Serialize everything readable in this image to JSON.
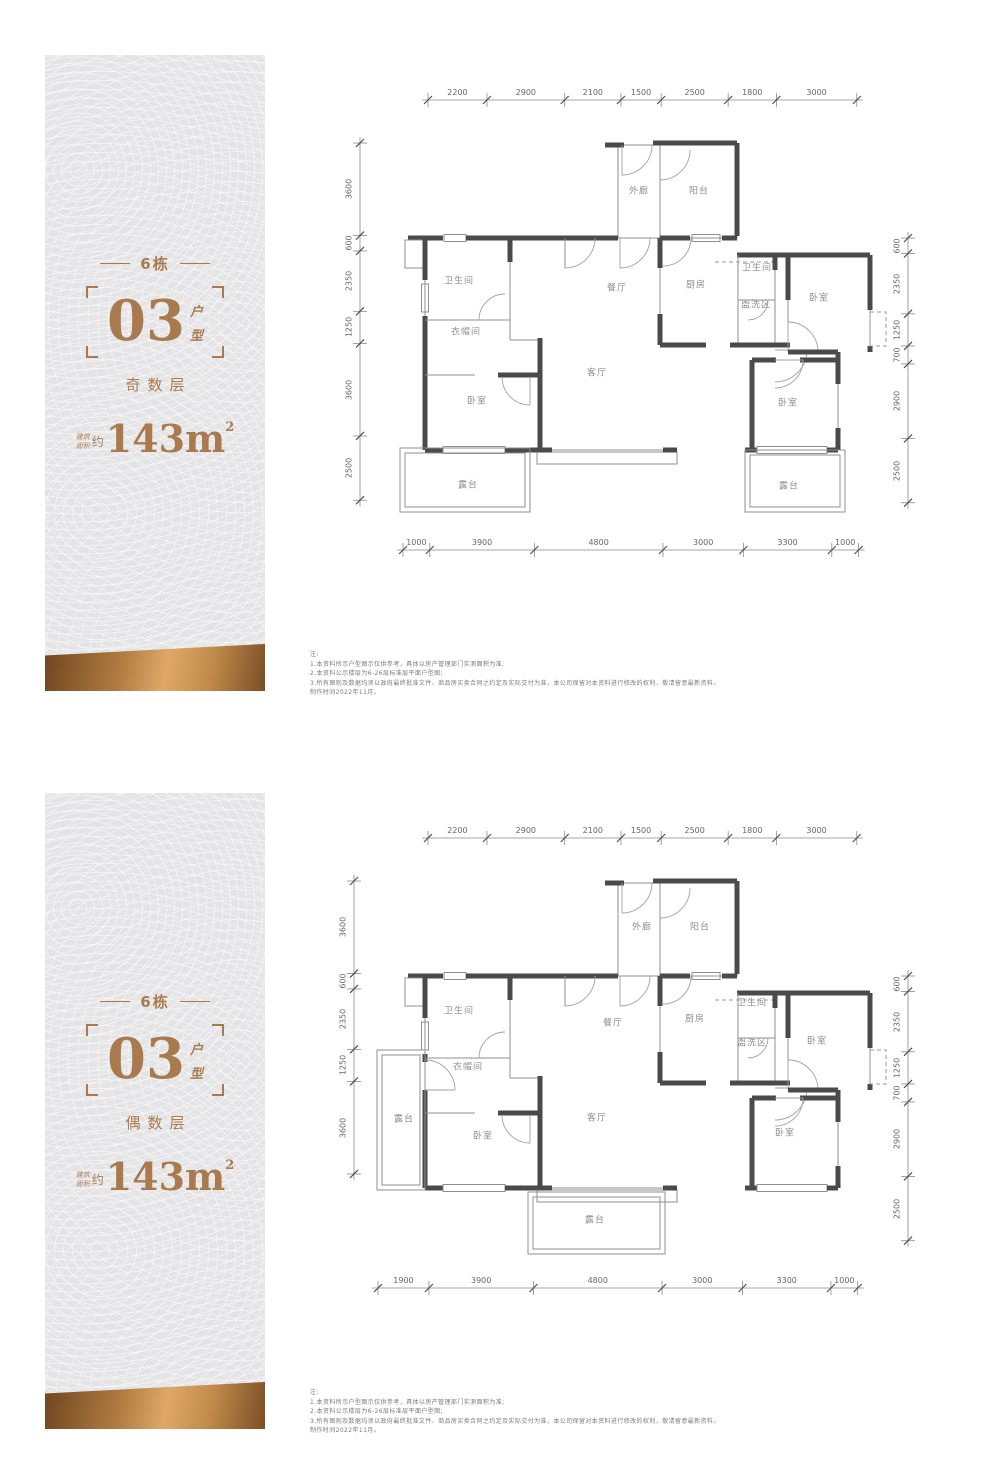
{
  "colors": {
    "bronze": "#a87a4e",
    "panel_bg": "#e4e4e6",
    "gold_dark": "#6f4520",
    "gold_light": "#dfa868",
    "wall_thick": "#4a4a4d",
    "wall_thin": "#8f8f92",
    "dim_text": "#66666a",
    "room_text": "#8f8f92",
    "note_text": "#7b7b7e"
  },
  "sections": [
    {
      "panel": {
        "building": "6栋",
        "unit": "03",
        "unit_side": [
          "户",
          "型"
        ],
        "floor_type": "奇数层",
        "area_small": [
          "建筑",
          "面积"
        ],
        "area_approx": "约",
        "area_value": "143m",
        "area_sup": "2"
      },
      "plan": {
        "dims_top": [
          "2200",
          "2900",
          "2100",
          "1500",
          "2500",
          "1800",
          "3000"
        ],
        "dims_bottom": [
          "1000",
          "3900",
          "4800",
          "3000",
          "3300",
          "1000"
        ],
        "dims_left": [
          "3600",
          "600",
          "2350",
          "1250",
          "3600",
          "2500"
        ],
        "dims_right": [
          "600",
          "2350",
          "1250",
          "700",
          "2900",
          "2500"
        ],
        "rooms": [
          {
            "label": "外廊",
            "x": 639,
            "y": 190
          },
          {
            "label": "阳台",
            "x": 699,
            "y": 190
          },
          {
            "label": "卫生间",
            "x": 459,
            "y": 280
          },
          {
            "label": "衣帽间",
            "x": 466,
            "y": 331
          },
          {
            "label": "餐厅",
            "x": 617,
            "y": 287
          },
          {
            "label": "厨房",
            "x": 696,
            "y": 284
          },
          {
            "label": "卫生间",
            "x": 757,
            "y": 267
          },
          {
            "label": "盥洗区",
            "x": 756,
            "y": 304
          },
          {
            "label": "卧室",
            "x": 819,
            "y": 297
          },
          {
            "label": "客厅",
            "x": 597,
            "y": 372
          },
          {
            "label": "卧室",
            "x": 477,
            "y": 400
          },
          {
            "label": "卧室",
            "x": 788,
            "y": 402
          },
          {
            "label": "露台",
            "x": 468,
            "y": 484
          },
          {
            "label": "露台",
            "x": 789,
            "y": 485
          }
        ]
      },
      "notes": [
        "注:",
        "1.本资料所示户型图示仅供参考，具体以房产管理部门实测面积为准;",
        "2.本资料公示楼层为6-26层标准层平面户型图;",
        "3.所有图则及数据均须以政府最终批准文件、商品房买卖合同之约定及实际交付为准，本公司保留对本资料进行修改的权利，敬请留意最新资料。",
        "制作时间2022年11月。"
      ]
    },
    {
      "panel": {
        "building": "6栋",
        "unit": "03",
        "unit_side": [
          "户",
          "型"
        ],
        "floor_type": "偶数层",
        "area_small": [
          "建筑",
          "面积"
        ],
        "area_approx": "约",
        "area_value": "143m",
        "area_sup": "2"
      },
      "plan": {
        "dims_top": [
          "2200",
          "2900",
          "2100",
          "1500",
          "2500",
          "1800",
          "3000"
        ],
        "dims_bottom": [
          "1900",
          "3900",
          "4800",
          "3000",
          "3300",
          "1000"
        ],
        "dims_left": [
          "3600",
          "600",
          "2350",
          "1250",
          "3600"
        ],
        "dims_right": [
          "600",
          "2350",
          "1250",
          "700",
          "2900",
          "2500"
        ],
        "rooms": [
          {
            "label": "外廊",
            "x": 642,
            "y": 926
          },
          {
            "label": "阳台",
            "x": 700,
            "y": 926
          },
          {
            "label": "卫生间",
            "x": 459,
            "y": 1010
          },
          {
            "label": "衣帽间",
            "x": 468,
            "y": 1066
          },
          {
            "label": "餐厅",
            "x": 613,
            "y": 1022
          },
          {
            "label": "厨房",
            "x": 695,
            "y": 1018
          },
          {
            "label": "卫生间",
            "x": 752,
            "y": 1002
          },
          {
            "label": "盥洗区",
            "x": 752,
            "y": 1042
          },
          {
            "label": "卧室",
            "x": 817,
            "y": 1040
          },
          {
            "label": "露台",
            "x": 404,
            "y": 1118
          },
          {
            "label": "卧室",
            "x": 483,
            "y": 1135
          },
          {
            "label": "客厅",
            "x": 597,
            "y": 1117
          },
          {
            "label": "卧室",
            "x": 785,
            "y": 1132
          },
          {
            "label": "露台",
            "x": 595,
            "y": 1219
          }
        ]
      },
      "notes": [
        "注:",
        "1.本资料所示户型图示仅供参考，具体以房产管理部门实测面积为准;",
        "2.本资料公示楼层为6-26层标准层平面户型图;",
        "3.所有图则及数据均须以政府最终批准文件、商品房买卖合同之约定及实际交付为准，本公司保留对本资料进行修改的权利，敬请留意最新资料。",
        "制作时间2022年11月。"
      ]
    }
  ]
}
